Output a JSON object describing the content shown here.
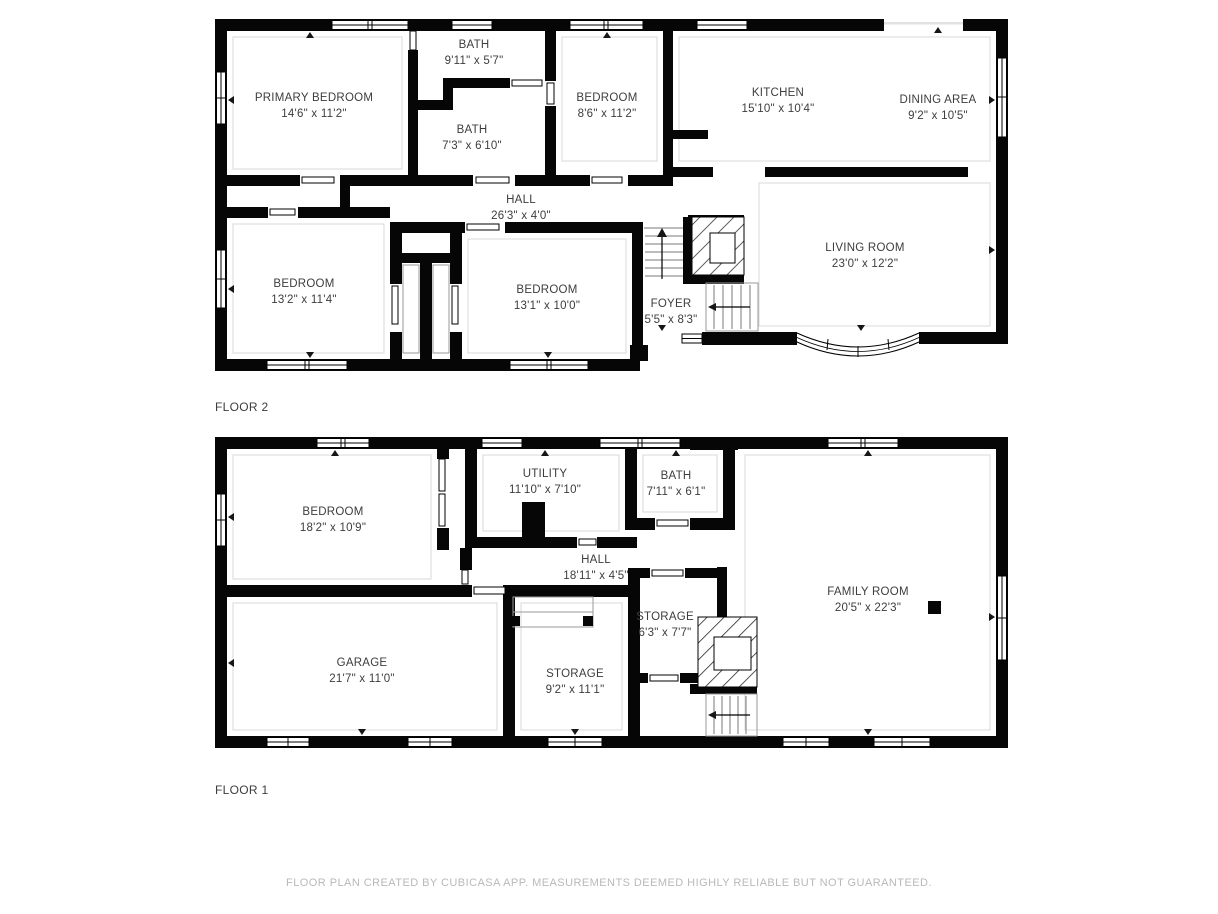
{
  "colors": {
    "wall": "#000000",
    "label_text": "#3d3d3d",
    "footer_text": "#b9b9b9",
    "background": "#ffffff"
  },
  "floors": [
    {
      "label": "FLOOR 2",
      "rooms": [
        {
          "name": "PRIMARY BEDROOM",
          "dims": "14'6\" x 11'2\""
        },
        {
          "name": "BATH",
          "dims": "9'11\" x 5'7\""
        },
        {
          "name": "BATH",
          "dims": "7'3\" x 6'10\""
        },
        {
          "name": "BEDROOM",
          "dims": "8'6\" x 11'2\""
        },
        {
          "name": "KITCHEN",
          "dims": "15'10\" x 10'4\""
        },
        {
          "name": "DINING AREA",
          "dims": "9'2\" x 10'5\""
        },
        {
          "name": "HALL",
          "dims": "26'3\" x 4'0\""
        },
        {
          "name": "BEDROOM",
          "dims": "13'2\" x 11'4\""
        },
        {
          "name": "BEDROOM",
          "dims": "13'1\" x 10'0\""
        },
        {
          "name": "FOYER",
          "dims": "5'5\" x 8'3\""
        },
        {
          "name": "LIVING ROOM",
          "dims": "23'0\" x 12'2\""
        }
      ]
    },
    {
      "label": "FLOOR 1",
      "rooms": [
        {
          "name": "BEDROOM",
          "dims": "18'2\" x 10'9\""
        },
        {
          "name": "UTILITY",
          "dims": "11'10\" x 7'10\""
        },
        {
          "name": "BATH",
          "dims": "7'11\" x 6'1\""
        },
        {
          "name": "HALL",
          "dims": "18'11\" x 4'5\""
        },
        {
          "name": "FAMILY ROOM",
          "dims": "20'5\" x 22'3\""
        },
        {
          "name": "GARAGE",
          "dims": "21'7\" x 11'0\""
        },
        {
          "name": "STORAGE",
          "dims": "9'2\" x 11'1\""
        },
        {
          "name": "STORAGE",
          "dims": "6'3\" x 7'7\""
        }
      ]
    }
  ],
  "footer": {
    "text": "FLOOR PLAN CREATED BY CUBICASA APP. MEASUREMENTS DEEMED HIGHLY RELIABLE BUT NOT GUARANTEED."
  }
}
